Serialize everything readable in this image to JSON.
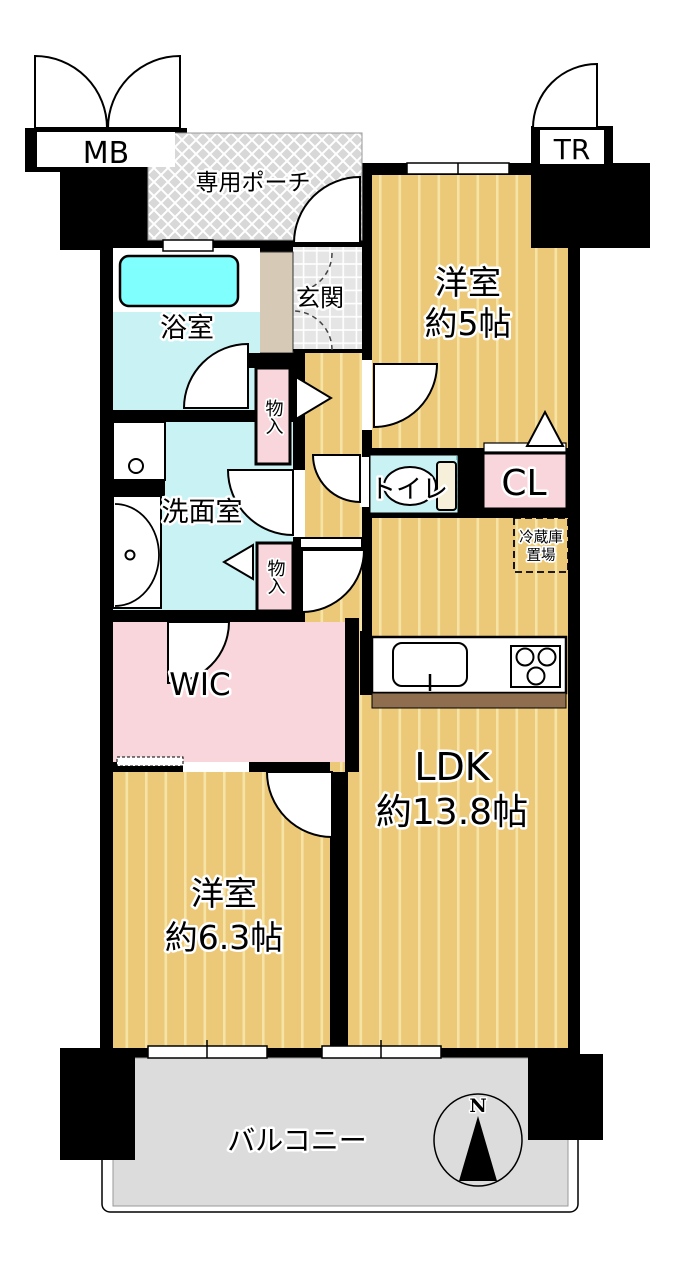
{
  "labels": {
    "mb": "MB",
    "tr": "TR",
    "porch": "専用ポーチ",
    "genkan": "玄関",
    "bath": "浴室",
    "washroom": "洗面室",
    "storage_upper": "物入",
    "storage_lower": "物入",
    "wic": "WIC",
    "toilet": "トイレ",
    "closet": "CL",
    "fridge_line1": "冷蔵庫",
    "fridge_line2": "置場",
    "west5_line1": "洋室",
    "west5_line2": "約5帖",
    "ldk_line1": "LDK",
    "ldk_line2": "約13.8帖",
    "west63_line1": "洋室",
    "west63_line2": "約6.3帖",
    "balcony": "バルコニー",
    "compass_north": "N"
  },
  "colors": {
    "wall": "#000000",
    "tatami_base": "#ecc978",
    "tatami_stripe": "#f6e3a6",
    "water_room": "#c9f2f5",
    "bathtub": "#80ffff",
    "closet_pink": "#f9d6dc",
    "porch_gray": "#d8d8d8",
    "entry_tile": "#e5e5e5",
    "shoe_cabinet": "#d6c9b6",
    "balcony_gray": "#dcdcdc",
    "kitchen_counter_bar": "#8e6e4e",
    "toilet_tank": "#f6f0da"
  }
}
